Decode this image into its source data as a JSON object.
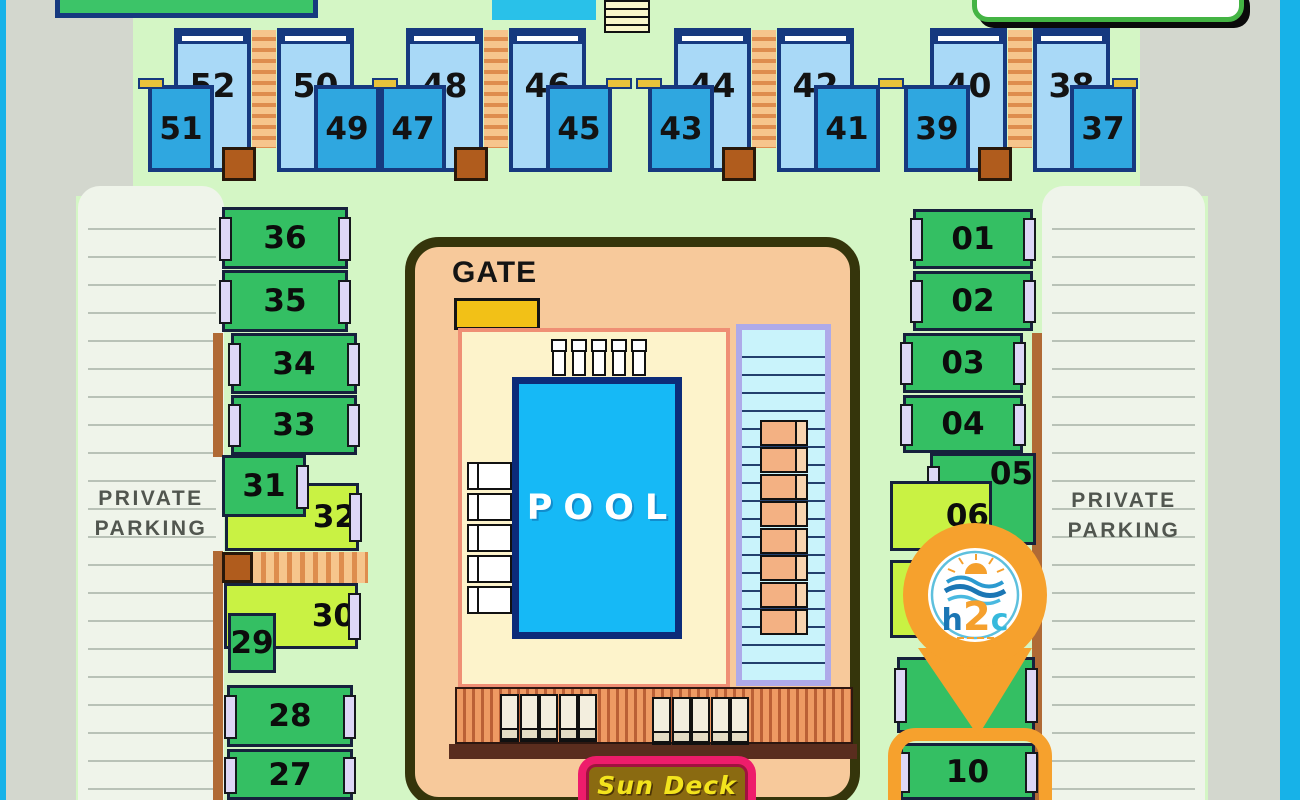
{
  "map_title": "h2c resort unit map",
  "banners": {
    "top_left_label": "",
    "top_center_label": "",
    "top_right_label": ""
  },
  "parking": {
    "left": {
      "line1": "PRIVATE",
      "line2": "PARKING"
    },
    "right": {
      "line1": "PRIVATE",
      "line2": "PARKING"
    }
  },
  "pool_area": {
    "gate_label": "GATE",
    "pool_label": "POOL",
    "chair_count": 5,
    "left_lounger_count": 5,
    "walkway_lounger_count": 8,
    "deck_lounger_counts": [
      5,
      5
    ]
  },
  "sun_deck": {
    "label": "Sun Deck"
  },
  "marker": {
    "logo_h": "h",
    "logo_2": "2",
    "logo_c": "c",
    "highlighted_unit": "10"
  },
  "units": {
    "top_row_pairs": [
      {
        "upper": "52",
        "lower": "51",
        "lower_side": "left"
      },
      {
        "upper": "50",
        "lower": "49",
        "lower_side": "right"
      },
      {
        "upper": "48",
        "lower": "47",
        "lower_side": "left"
      },
      {
        "upper": "46",
        "lower": "45",
        "lower_side": "right"
      },
      {
        "upper": "44",
        "lower": "43",
        "lower_side": "left"
      },
      {
        "upper": "42",
        "lower": "41",
        "lower_side": "right"
      },
      {
        "upper": "40",
        "lower": "39",
        "lower_side": "left"
      },
      {
        "upper": "38",
        "lower": "37",
        "lower_side": "right"
      }
    ],
    "left_column": [
      {
        "label": "36",
        "x": 222,
        "y": 207,
        "w": 126,
        "h": 62,
        "color": "green",
        "tabs": "lr"
      },
      {
        "label": "35",
        "x": 222,
        "y": 270,
        "w": 126,
        "h": 62,
        "color": "green",
        "tabs": "lr"
      },
      {
        "label": "34",
        "x": 231,
        "y": 333,
        "w": 126,
        "h": 61,
        "color": "green",
        "tabs": "lr"
      },
      {
        "label": "33",
        "x": 231,
        "y": 395,
        "w": 126,
        "h": 60,
        "color": "green",
        "tabs": "lr"
      },
      {
        "label": "32",
        "x": 225,
        "y": 483,
        "w": 134,
        "h": 68,
        "color": "lime",
        "tabs": "r",
        "align": "right"
      },
      {
        "label": "31",
        "x": 222,
        "y": 455,
        "w": 84,
        "h": 62,
        "color": "green",
        "tabs": "r"
      },
      {
        "label": "30",
        "x": 224,
        "y": 583,
        "w": 134,
        "h": 66,
        "color": "lime",
        "tabs": "r",
        "align": "right"
      },
      {
        "label": "29",
        "x": 228,
        "y": 613,
        "w": 48,
        "h": 60,
        "color": "green",
        "tabs": ""
      },
      {
        "label": "28",
        "x": 227,
        "y": 685,
        "w": 126,
        "h": 62,
        "color": "green",
        "tabs": "lr"
      },
      {
        "label": "27",
        "x": 227,
        "y": 749,
        "w": 126,
        "h": 51,
        "color": "green",
        "tabs": "lr"
      }
    ],
    "right_column": [
      {
        "label": "01",
        "x": 913,
        "y": 209,
        "w": 120,
        "h": 60,
        "color": "green",
        "tabs": "lr"
      },
      {
        "label": "02",
        "x": 913,
        "y": 271,
        "w": 120,
        "h": 60,
        "color": "green",
        "tabs": "lr"
      },
      {
        "label": "03",
        "x": 903,
        "y": 333,
        "w": 120,
        "h": 60,
        "color": "green",
        "tabs": "lr"
      },
      {
        "label": "04",
        "x": 903,
        "y": 395,
        "w": 120,
        "h": 58,
        "color": "green",
        "tabs": "lr"
      },
      {
        "label": "05",
        "x": 930,
        "y": 453,
        "w": 106,
        "h": 92,
        "color": "green",
        "tabs": "l",
        "align": "topright"
      },
      {
        "label": "06",
        "x": 890,
        "y": 481,
        "w": 102,
        "h": 70,
        "color": "lime",
        "tabs": "",
        "align": "right"
      },
      {
        "label": "",
        "x": 890,
        "y": 560,
        "w": 102,
        "h": 78,
        "color": "lime",
        "tabs": ""
      },
      {
        "label": "",
        "x": 897,
        "y": 657,
        "w": 138,
        "h": 76,
        "color": "green",
        "tabs": "lr"
      },
      {
        "label": "10",
        "x": 900,
        "y": 743,
        "w": 135,
        "h": 57,
        "color": "green",
        "tabs": "lr"
      }
    ]
  },
  "colors": {
    "background": "#d4f6c5",
    "edge_cyan": "#17b2e8",
    "side_gray": "#d3d7ce",
    "parking_bg": "#eff4ea",
    "parking_line": "#b9c2b7",
    "parking_text": "#51564f",
    "building_light": "#a9d9f7",
    "building_mid": "#2fa7e0",
    "navy": "#16397f",
    "unit_green": "#34bf63",
    "unit_lime": "#c9f243",
    "tab_lavender": "#ddd7f6",
    "ladder_tan": "#f6c58c",
    "ladder_rung": "#de8d4e",
    "stair_brown": "#b05c1d",
    "dash_yellow": "#e9c23b",
    "compound_border": "#35350b",
    "compound_fill": "#f7c99b",
    "deck_cream": "#fdf3cb",
    "deck_border": "#ef8f75",
    "gate_yellow": "#f2c117",
    "pool_blue": "#16b9f6",
    "pool_border": "#0c2b79",
    "walkway_bg": "#c9f3fb",
    "walkway_border": "#aeaae9",
    "walkway_line": "#23406e",
    "lounger_peach": "#f3b183",
    "sundeck_a": "#ee9a63",
    "sundeck_b": "#bb6036",
    "sundeck_base": "#5a2d1e",
    "sign_pink": "#ee1c6b",
    "sign_fill": "#8a6a11",
    "sign_text": "#f3e41d",
    "pin_orange": "#f6a12d",
    "logo_blue": "#1b76b4",
    "logo_cyan": "#36b9dc",
    "text_dark": "#131313"
  }
}
